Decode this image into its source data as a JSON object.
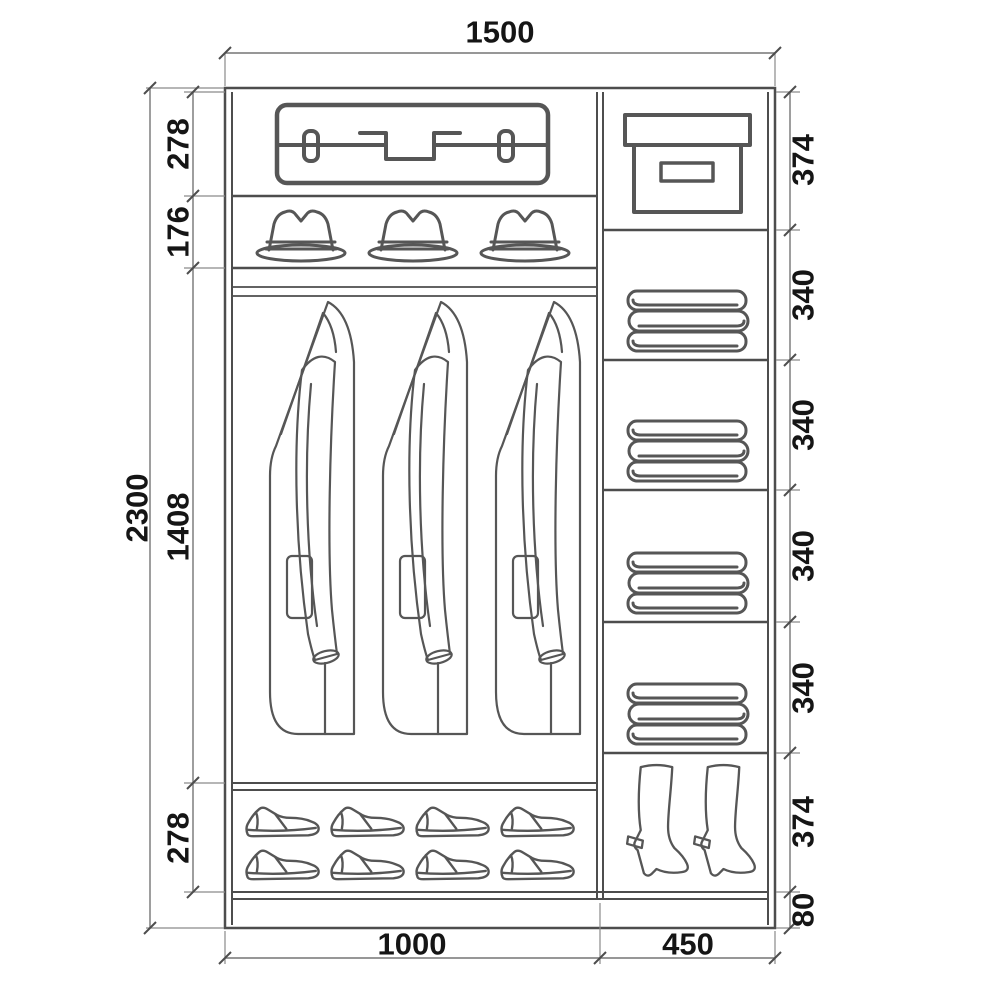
{
  "diagram_type": "wardrobe-interior-dimension-drawing",
  "colors": {
    "background": "#ffffff",
    "structure_line": "#4d4d4d",
    "icon_line": "#565656",
    "dimension_line": "#757575",
    "label_text": "#151515"
  },
  "dims": {
    "total_width": "1500",
    "total_height": "2300"
  },
  "left_column": {
    "width_label": "1000",
    "sections": [
      {
        "label": "278",
        "content": "suitcase shelf",
        "icon": "suitcase-icon"
      },
      {
        "label": "176",
        "content": "hat shelf (3 fedoras)",
        "icon": "fedora-hat-icon"
      },
      {
        "label": "1408",
        "content": "hanging rail with 3 coats",
        "icon": "hanging-coat-icon"
      },
      {
        "label": "278",
        "content": "shoe shelf (8 shoes)",
        "icon": "dress-shoe-icon"
      }
    ]
  },
  "right_column": {
    "width_label": "450",
    "sections": [
      {
        "label": "374",
        "content": "storage box shelf",
        "icon": "storage-box-icon"
      },
      {
        "label": "340",
        "content": "folded blanket shelf",
        "icon": "folded-blanket-icon"
      },
      {
        "label": "340",
        "content": "folded blanket shelf",
        "icon": "folded-blanket-icon"
      },
      {
        "label": "340",
        "content": "folded blanket shelf",
        "icon": "folded-blanket-icon"
      },
      {
        "label": "340",
        "content": "folded blanket shelf",
        "icon": "folded-blanket-icon"
      },
      {
        "label": "374",
        "content": "boot compartment",
        "icon": "high-heel-boot-icon"
      },
      {
        "label": "80",
        "content": "plinth"
      }
    ]
  }
}
